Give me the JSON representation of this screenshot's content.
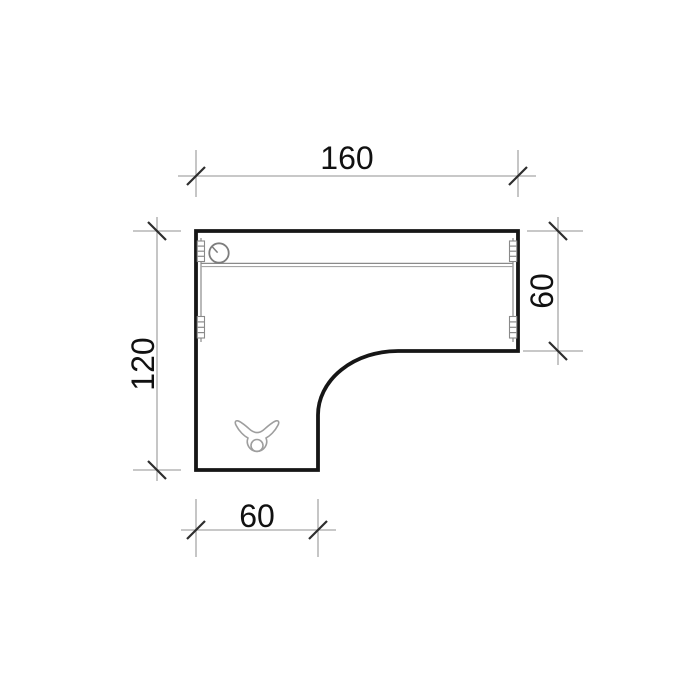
{
  "drawing": {
    "kind": "desk-top-plan-technical-drawing",
    "dimensions": {
      "top": {
        "label": "160"
      },
      "right": {
        "label": "60"
      },
      "left": {
        "label": "120"
      },
      "bottom": {
        "label": "60"
      }
    },
    "symbols": [
      "cable-grommet-hole",
      "cable-duct-rail",
      "connector-bracket-left-top",
      "connector-bracket-left-bottom",
      "connector-bracket-right-top",
      "connector-bracket-right-bottom",
      "cable-clip-clamp"
    ],
    "colors": {
      "background": "#ffffff",
      "outline": "#161616",
      "detail": "#8a8a8a",
      "detail_light": "#a6a6a6",
      "dim_line": "#a8a8a8",
      "tick": "#2e2e2e",
      "text": "#111111"
    }
  }
}
